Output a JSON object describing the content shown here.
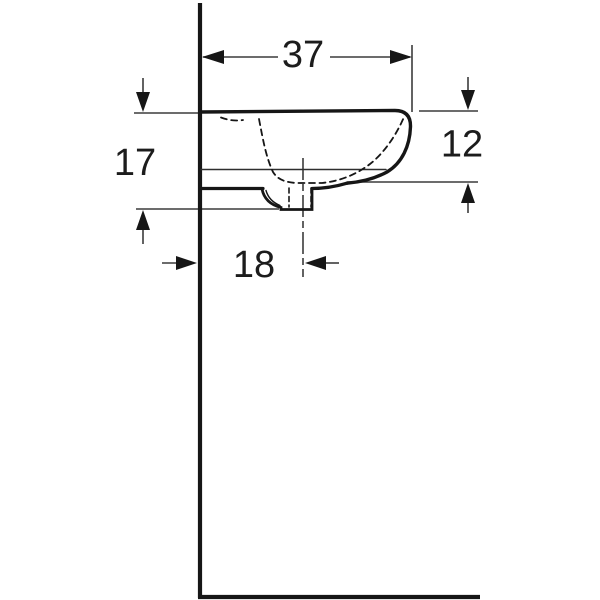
{
  "drawing": {
    "dimensions": {
      "width_top": {
        "value": "37"
      },
      "height_left": {
        "value": "17"
      },
      "height_right": {
        "value": "12"
      },
      "drain_offset": {
        "value": "18"
      }
    },
    "colors": {
      "outline": "#161616",
      "thin_line": "#3c3c3c",
      "background": "#ffffff"
    }
  }
}
